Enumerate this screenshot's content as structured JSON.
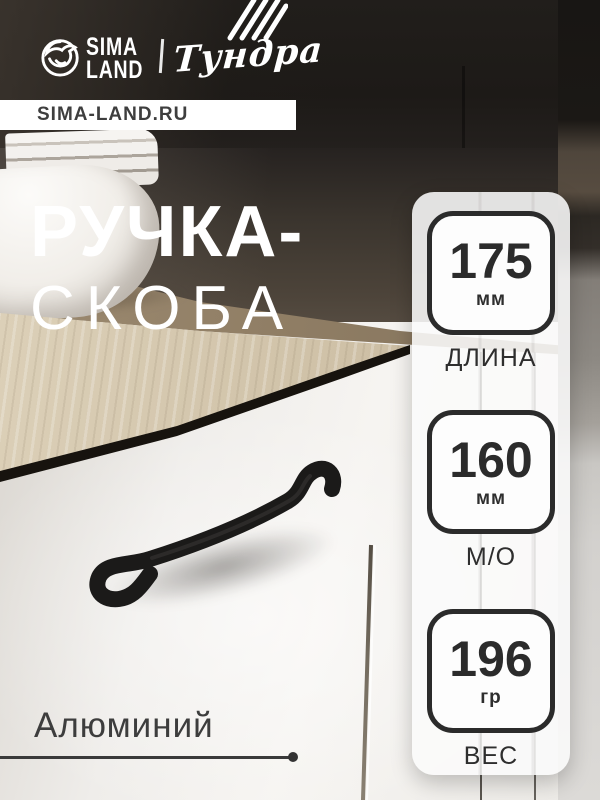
{
  "brand": {
    "sima": {
      "line1": "SIMA",
      "line2": "LAND"
    },
    "partner_logo": "Тундра",
    "website": "SIMA-LAND.RU"
  },
  "title": {
    "line1": "РУЧКА-",
    "line2": "СКОБА"
  },
  "specs": [
    {
      "value": "175",
      "unit": "мм",
      "label": "ДЛИНА"
    },
    {
      "value": "160",
      "unit": "мм",
      "label": "М/О"
    },
    {
      "value": "196",
      "unit": "гр",
      "label": "ВЕС"
    }
  ],
  "material": "Алюминий",
  "colors": {
    "accent_dark": "#2b2b2b",
    "text_light": "#ffffff",
    "panel_bg": "rgba(251,251,251,0.88)"
  }
}
